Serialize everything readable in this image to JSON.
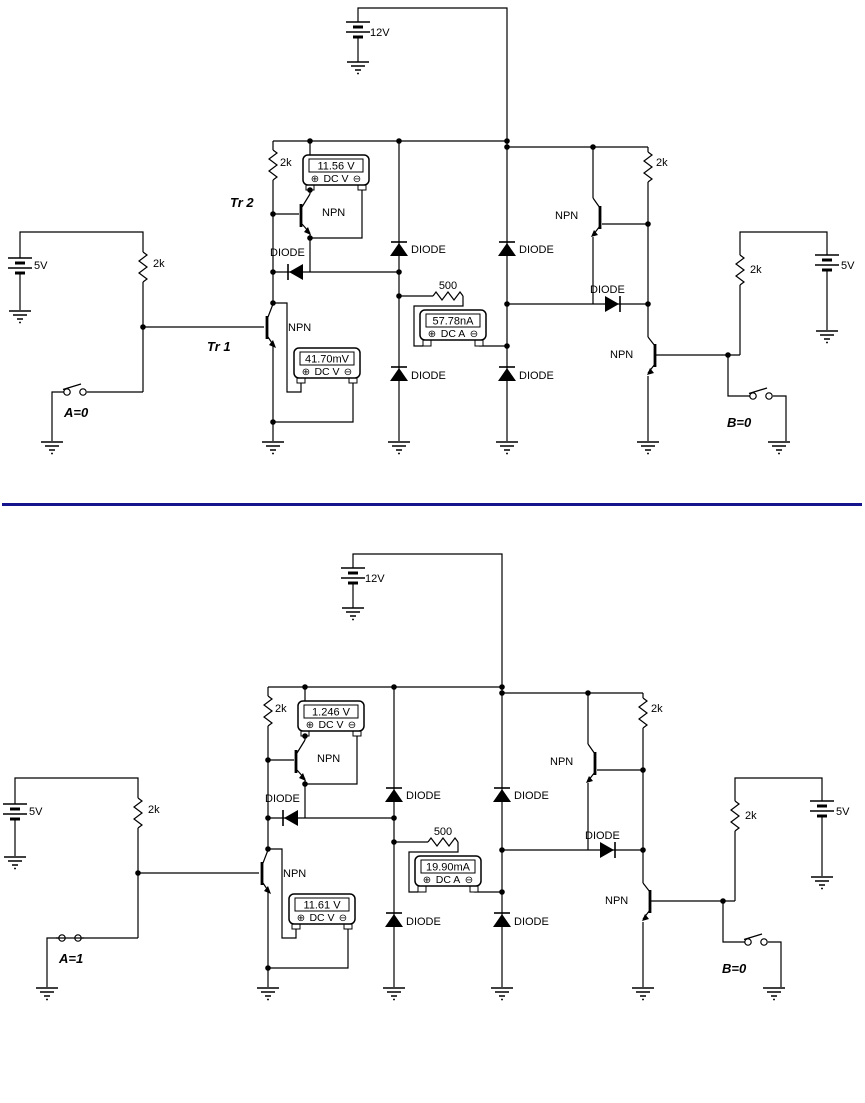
{
  "sym": {
    "plus": "⊕",
    "minus": "⊖"
  },
  "divider": {
    "color": "#14148c"
  },
  "c1": {
    "supply": "12V",
    "vleft": "5V",
    "vright": "5V",
    "r_input": "2k",
    "r_bias": "2k",
    "r_collector": "2k",
    "r_output": "2k",
    "r_series": "500",
    "npn": "NPN",
    "diode": "DIODE",
    "tr1": "Tr 1",
    "tr2": "Tr 2",
    "m1": {
      "reading": "11.56 V",
      "mode": "DC V"
    },
    "m2": {
      "reading": "41.70mV",
      "mode": "DC V"
    },
    "m3": {
      "reading": "57.78nA",
      "mode": "DC A"
    },
    "sw_a": "A=0",
    "sw_b": "B=0"
  },
  "c2": {
    "supply": "12V",
    "vleft": "5V",
    "vright": "5V",
    "r_input": "2k",
    "r_bias": "2k",
    "r_collector": "2k",
    "r_output": "2k",
    "r_series": "500",
    "npn": "NPN",
    "diode": "DIODE",
    "m1": {
      "reading": "1.246 V",
      "mode": "DC V"
    },
    "m2": {
      "reading": "11.61 V",
      "mode": "DC V"
    },
    "m3": {
      "reading": "19.90mA",
      "mode": "DC A"
    },
    "sw_a": "A=1",
    "sw_b": "B=0"
  }
}
